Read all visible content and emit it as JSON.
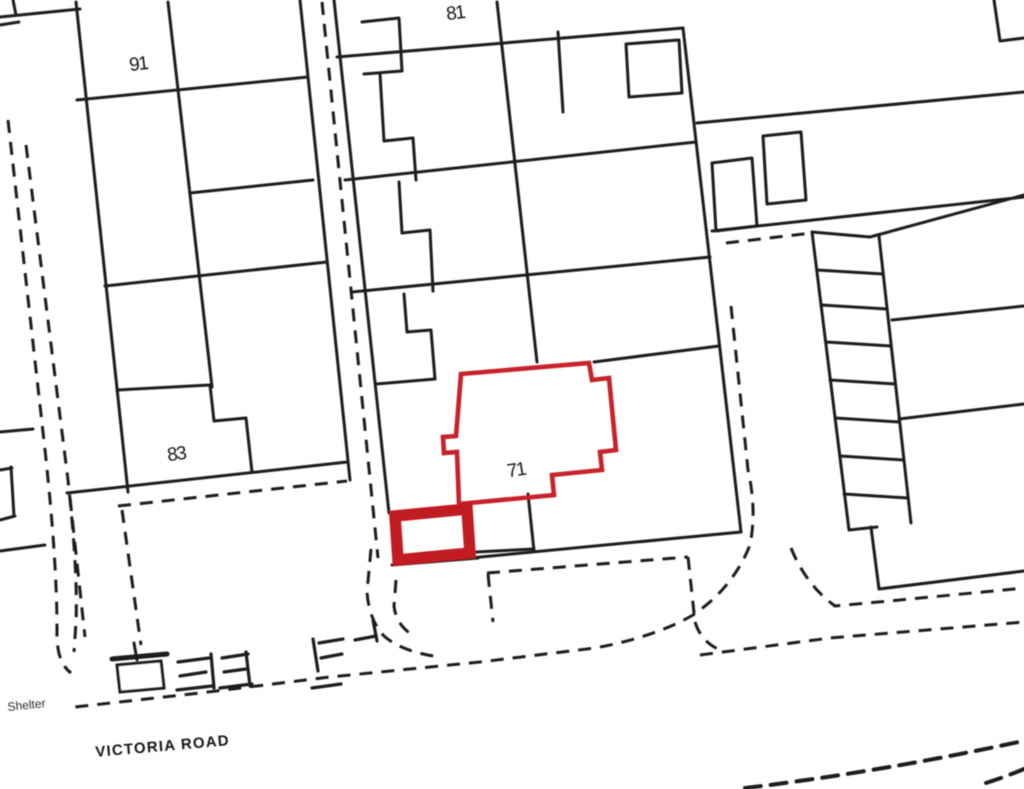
{
  "map": {
    "parcel_labels": {
      "p91": "91",
      "p81": "81",
      "p83": "83",
      "p71": "71"
    },
    "road_label": "VICTORIA ROAD",
    "shelter_label": "Shelter",
    "colors": {
      "line_ink": "#1e1e1e",
      "highlight_red": "#c8202a",
      "site_red": "#c01f24",
      "background": "#ffffff"
    }
  }
}
